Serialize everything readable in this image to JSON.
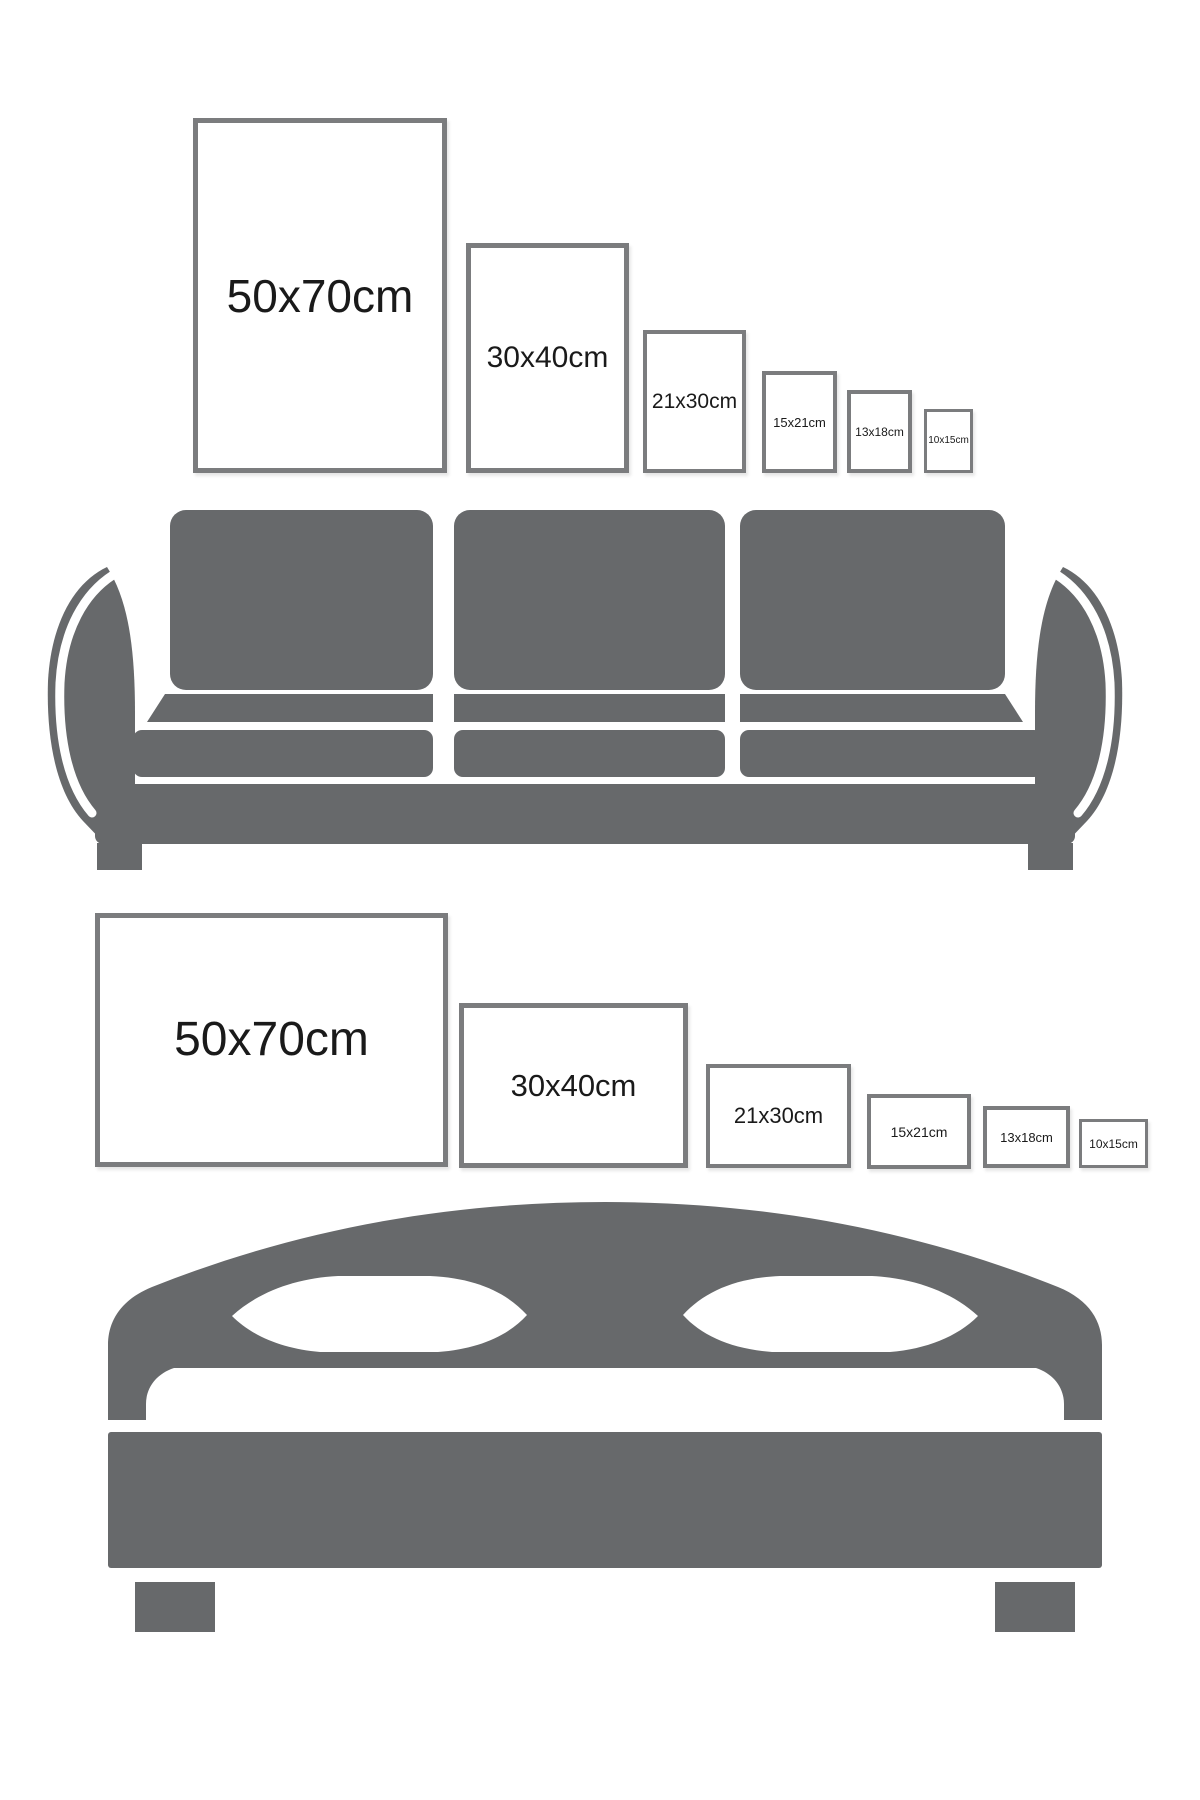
{
  "page": {
    "width": 1200,
    "height": 1800,
    "background": "#ffffff",
    "description": "Poster frame size comparison chart above a sofa (portrait frames) and above a bed (landscape frames)"
  },
  "colors": {
    "furniture_gray": "#67696b",
    "frame_border": "#7b7c7e",
    "frame_fill": "#ffffff",
    "label_text": "#1a1a1a",
    "page_bg": "#ffffff"
  },
  "scenes": [
    {
      "id": "sofa",
      "furniture": "sofa-illustration",
      "orientation": "portrait",
      "frames": [
        {
          "label": "50x70cm",
          "width_cm": 50,
          "height_cm": 70,
          "left": 193,
          "top": 118,
          "width": 254,
          "height": 355,
          "font_size": 46,
          "border": 5
        },
        {
          "label": "30x40cm",
          "width_cm": 30,
          "height_cm": 40,
          "left": 466,
          "top": 243,
          "width": 163,
          "height": 230,
          "font_size": 30,
          "border": 5
        },
        {
          "label": "21x30cm",
          "width_cm": 21,
          "height_cm": 30,
          "left": 643,
          "top": 330,
          "width": 103,
          "height": 143,
          "font_size": 21,
          "border": 4
        },
        {
          "label": "15x21cm",
          "width_cm": 15,
          "height_cm": 21,
          "left": 762,
          "top": 371,
          "width": 75,
          "height": 102,
          "font_size": 13,
          "border": 4
        },
        {
          "label": "13x18cm",
          "width_cm": 13,
          "height_cm": 18,
          "left": 847,
          "top": 390,
          "width": 65,
          "height": 83,
          "font_size": 12,
          "border": 4
        },
        {
          "label": "10x15cm",
          "width_cm": 10,
          "height_cm": 15,
          "left": 924,
          "top": 409,
          "width": 49,
          "height": 64,
          "font_size": 10,
          "border": 3
        }
      ]
    },
    {
      "id": "bed",
      "furniture": "bed-illustration",
      "orientation": "landscape",
      "frames": [
        {
          "label": "50x70cm",
          "width_cm": 70,
          "height_cm": 50,
          "left": 95,
          "top": 913,
          "width": 353,
          "height": 254,
          "font_size": 48,
          "border": 5
        },
        {
          "label": "30x40cm",
          "width_cm": 40,
          "height_cm": 30,
          "left": 459,
          "top": 1003,
          "width": 229,
          "height": 165,
          "font_size": 31,
          "border": 5
        },
        {
          "label": "21x30cm",
          "width_cm": 30,
          "height_cm": 21,
          "left": 706,
          "top": 1064,
          "width": 145,
          "height": 104,
          "font_size": 22,
          "border": 4
        },
        {
          "label": "15x21cm",
          "width_cm": 21,
          "height_cm": 15,
          "left": 867,
          "top": 1094,
          "width": 104,
          "height": 75,
          "font_size": 14,
          "border": 4
        },
        {
          "label": "13x18cm",
          "width_cm": 18,
          "height_cm": 13,
          "left": 983,
          "top": 1106,
          "width": 87,
          "height": 62,
          "font_size": 13,
          "border": 4
        },
        {
          "label": "10x15cm",
          "width_cm": 15,
          "height_cm": 10,
          "left": 1079,
          "top": 1119,
          "width": 69,
          "height": 49,
          "font_size": 12,
          "border": 3
        }
      ]
    }
  ]
}
